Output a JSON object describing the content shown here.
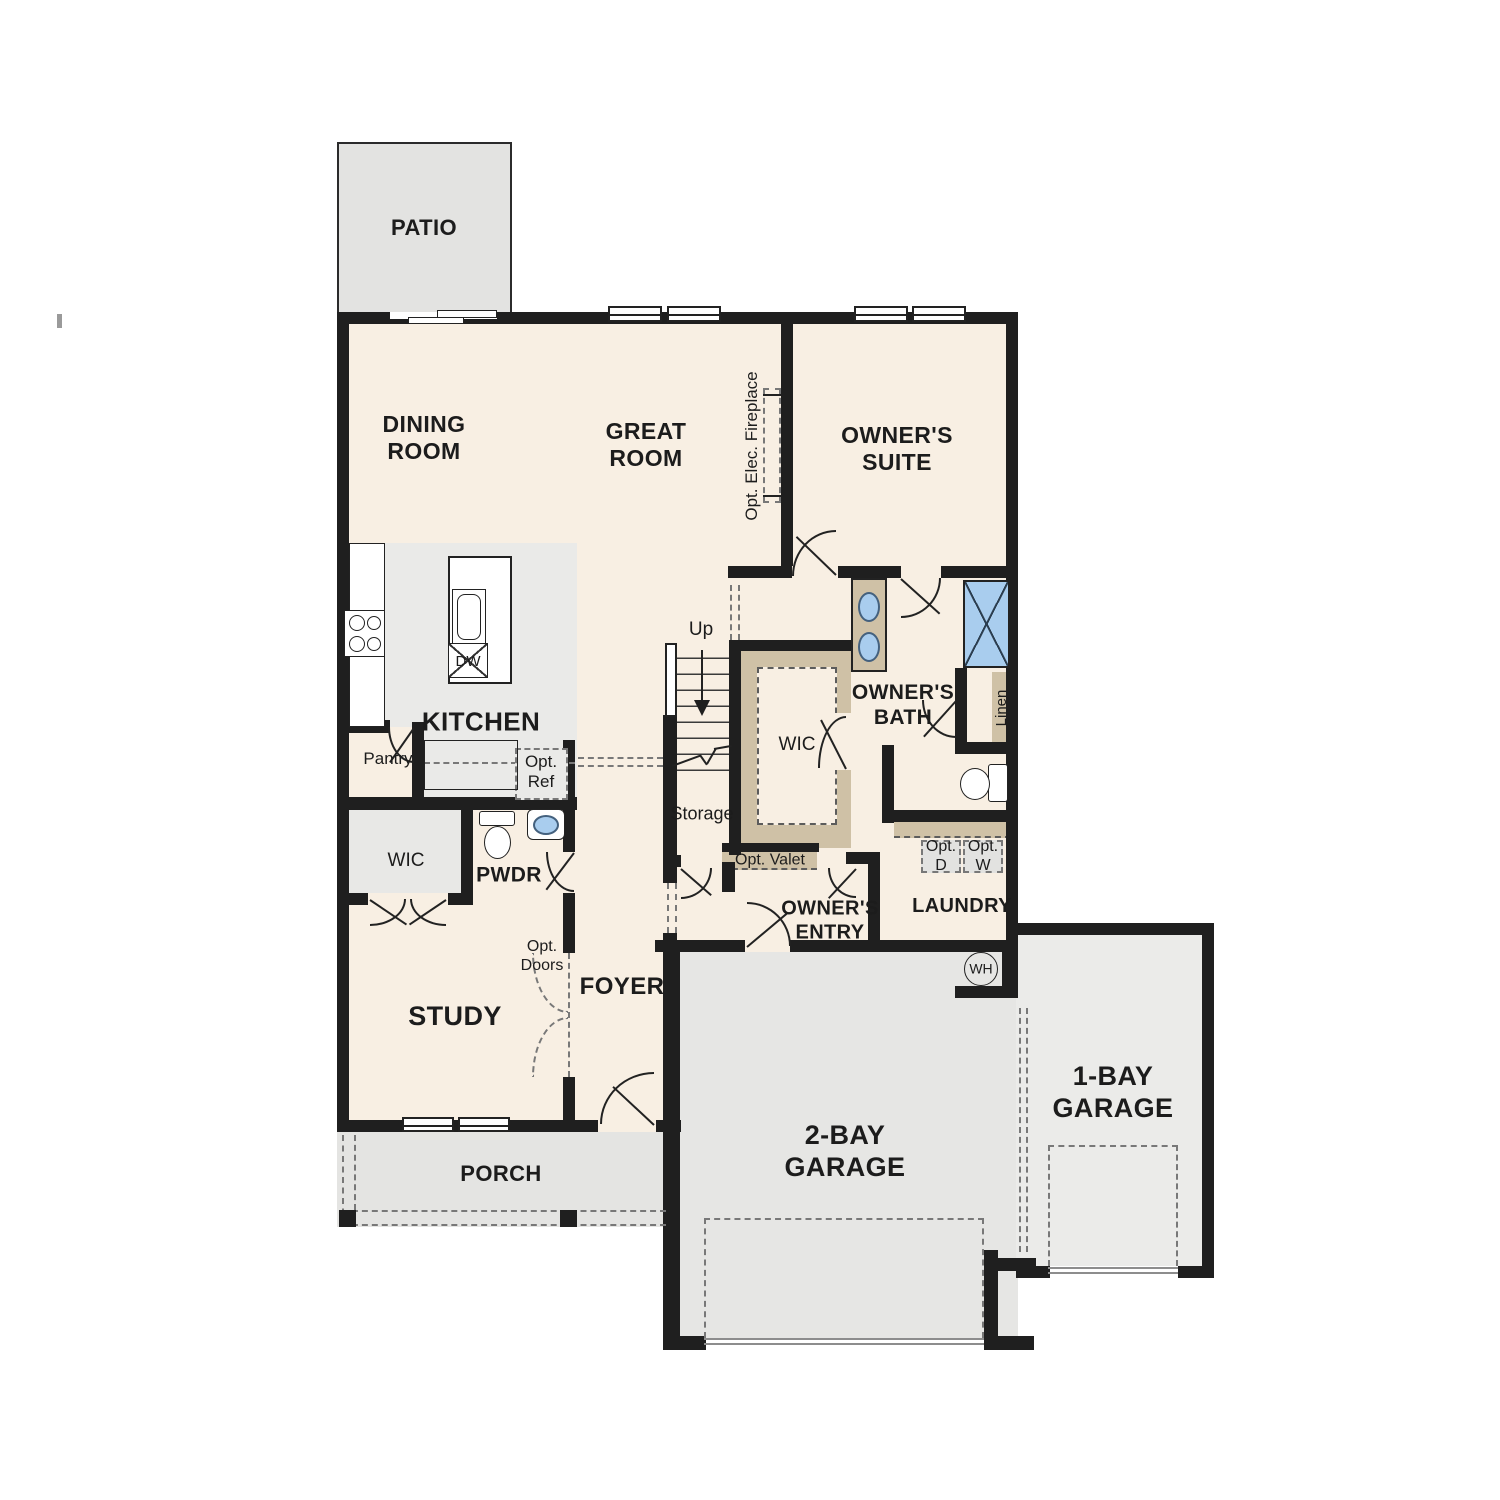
{
  "plan": {
    "colors": {
      "wall": "#1f1f1f",
      "line": "#222222",
      "floor": "#f8efe3",
      "patio": "#e3e3e1",
      "kfloor": "#eaeae8",
      "wicfloor": "#e8e8e6",
      "porch": "#e4e4e2",
      "g2": "#e6e6e4",
      "g1": "#ebebe9",
      "tan": "#cfc1a6",
      "blue": "#a9cdee",
      "dashc": "#787878"
    },
    "rooms": {
      "patio": "PATIO",
      "dining": "DINING ROOM",
      "great": "GREAT ROOM",
      "suite": "OWNER'S SUITE",
      "fireplace": "Opt. Elec. Fireplace",
      "kitchen": "KITCHEN",
      "dw": "DW",
      "pantry": "Pantry",
      "opt_ref": "Opt. Ref",
      "up": "Up",
      "storage": "Storage",
      "wic_owner": "WIC",
      "bath": "OWNER'S BATH",
      "linen": "Linen",
      "opt_valet": "Opt. Valet",
      "opt_d": "Opt. D",
      "opt_w": "Opt. W",
      "laundry": "LAUNDRY",
      "entry": "OWNER'S ENTRY",
      "wh": "WH",
      "wic_study": "WIC",
      "pwdr": "PWDR",
      "study": "STUDY",
      "opt_doors": "Opt. Doors",
      "foyer": "FOYER",
      "porch": "PORCH",
      "garage2": "2-BAY GARAGE",
      "garage1": "1-BAY GARAGE"
    }
  }
}
